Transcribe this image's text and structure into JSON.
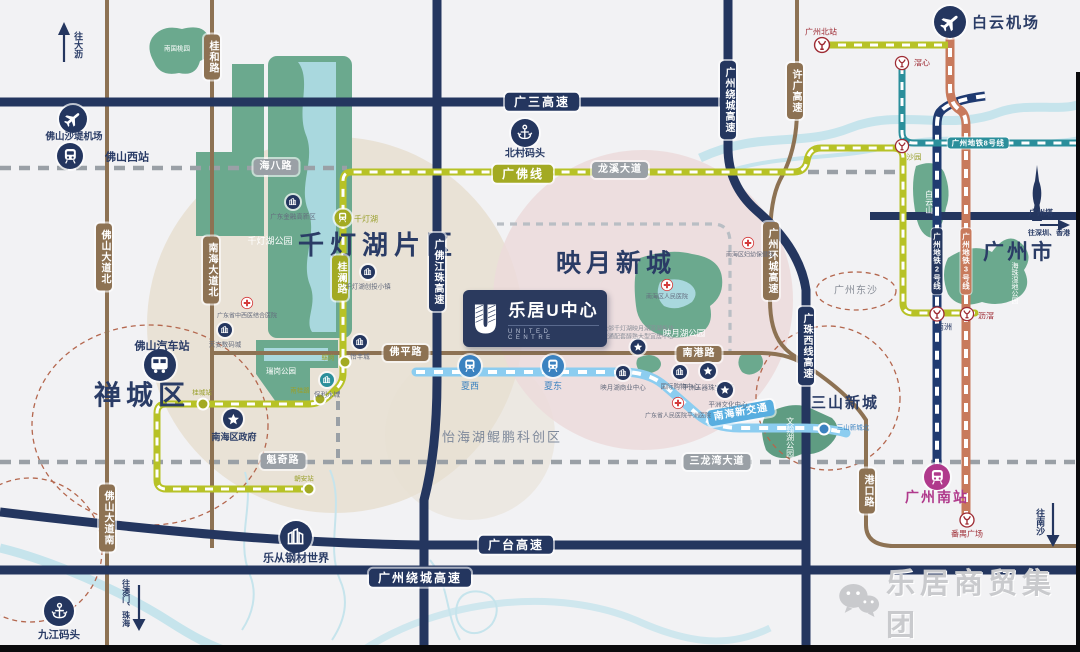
{
  "colors": {
    "navy": "#24365f",
    "brown": "#8d7253",
    "olive": "#a3aa23",
    "teal": "#2b8f9b",
    "metro2_navy": "#1f3a70",
    "metro3_orange": "#c87a5c",
    "light_blue": "#8ccdf0",
    "maroon": "#9e2b33",
    "magenta": "#b03a8c",
    "park_green": "#6ba98e",
    "water": "#a9d8de",
    "tan_zone": "#e8e0d3",
    "pink_zone": "#ecdbdb"
  },
  "regions": {
    "qiandenghu_area": "千灯湖片区",
    "yingyue_area": "映月新城",
    "guangzhou_city": "广州市",
    "chancheng_area": "禅城区",
    "sanshan_area": "三山新城",
    "yihaihu_area": "怡海湖鲲鹏科创区",
    "dongsha_area": "广州东沙"
  },
  "roads": {
    "guangsan": "广三高速",
    "raocheng_top": "广州绕城高速",
    "raocheng_bottom": "广州绕城高速",
    "guangtai": "广台高速",
    "guangfo_jiangzhu": "广佛江珠高速",
    "guangzhu_xixian": "广珠西线高速",
    "xuguang": "许广高速",
    "huancheng": "广州环城高速",
    "guihe": "桂和路",
    "nanhai_dadao_bei": "南海大道北",
    "foshan_dadao_bei": "佛山大道北",
    "foshan_dadao_nan": "佛山大道南",
    "haiba": "海八路",
    "longxi": "龙溪大道",
    "kuiqi": "魁奇路",
    "sanlongwan": "三龙湾大道",
    "foping": "佛平路",
    "nangang": "南港路",
    "gangkou": "港口路",
    "guilan": "桂澜路"
  },
  "transit": {
    "guangfo_line": "广佛线",
    "line2": "广州地铁2号线",
    "line3": "广州地铁3号线",
    "line8": "广州地铁8号线",
    "nanhai_new_transit": "南海新交通"
  },
  "stations": {
    "foshan_xi": "佛山西站",
    "shatang_airport": "佛山沙堤机场",
    "baiyun_airport": "白云机场",
    "guangzhou_bei": "广州北站",
    "jiaoxin": "滘心",
    "shayuan": "沙园",
    "nanzhou": "南洲",
    "lijiao": "沥滘",
    "panyu_square": "番禺广场",
    "guangzhou_nan": "广州南站",
    "xiaxi": "夏西",
    "xiadong": "夏东",
    "qiandenghu": "千灯湖",
    "leigang": "𧒽岗",
    "nanguilu": "南桂路",
    "guicheng": "桂城站",
    "chaoan": "朝安站",
    "sanshan_bei": "三山新城北",
    "foshan_bus": "佛山汽车站",
    "beicun_wharf": "北村码头",
    "jiujiang_wharf": "九江码头"
  },
  "pois": {
    "financial_zone": "广东金融高新区",
    "chuangtou_town": "千灯湖创投小镇",
    "zhongxiyi_hospital": "广东省中西医结合医院",
    "tianan_digital": "天安数码城",
    "yifeng_city": "怡丰城",
    "baoli_watercity": "保利水城",
    "yingyuehu_mall": "映月湖商业中心",
    "intl_mall": "国际购物中心",
    "yuqi_town": "平洲玉器珠宝小镇",
    "wenhua_center": "平洲文化中心",
    "renmin_hospital_pz": "广东省人民医院平洲医院",
    "fuyou_hospital": "南海区妇幼保健院",
    "nanhai_hospital": "南海区人民医院",
    "nanhai_gov": "南海区政府",
    "lecong_steel": "乐从钢材世界",
    "canton_tower": "广州塔"
  },
  "parks": {
    "qiandenghu_park": "千灯湖公园",
    "ruigang_park": "瑞岗公园",
    "yingyuehu_park": "映月湖公园",
    "wenhanhu_park": "文翰湖公园",
    "baiyunshan": "白云山",
    "haizhu_wetland": "海珠湿地公园",
    "nanguo_taoyuan": "南国桃园"
  },
  "arrows": {
    "dali": "往大沥",
    "shenzhen_hk": "往深圳、香港",
    "nansha": "往南沙",
    "macau_zhuhai": "往澳门、珠海"
  },
  "caption": {
    "line1": "毗邻千灯湖映月湖双湖板块",
    "line2": "交通配套醇熟大型宜居中心"
  },
  "logo": {
    "title": "乐居U中心",
    "subtitle": "UNITED CENTRE"
  },
  "footer": {
    "brand": "乐居商贸集团"
  }
}
